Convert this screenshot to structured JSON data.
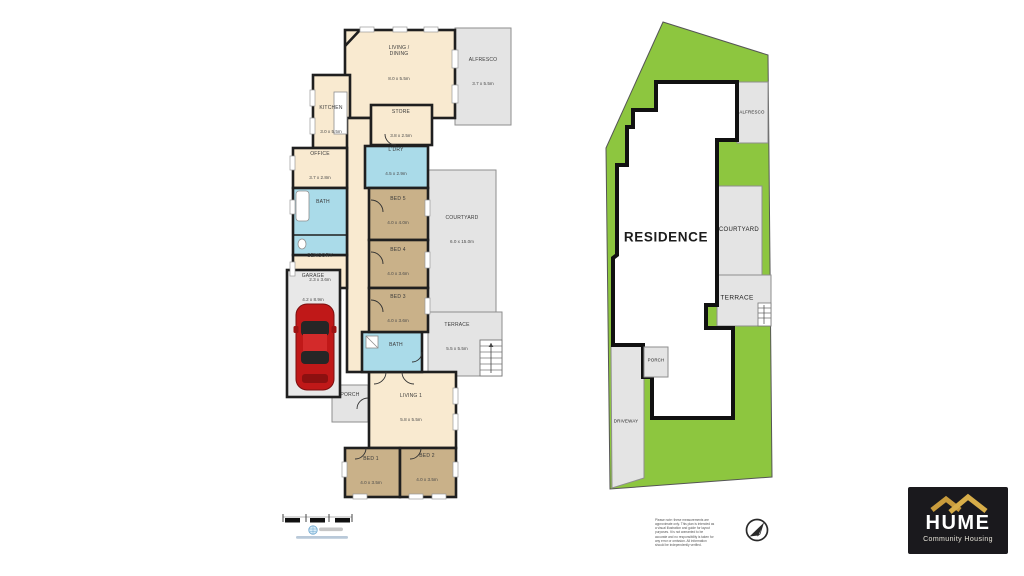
{
  "colors": {
    "room_cream": "#f9ead0",
    "room_tan": "#c9b189",
    "room_blue": "#aadbe9",
    "outdoor_gray": "#e4e4e4",
    "lot_green": "#8dc63f",
    "wall": "#1f1f1f",
    "brand_gold": "#c89b3c",
    "brand_gold_light": "#d7ad49",
    "brand_bg": "#1a191d",
    "car_red": "#c01818"
  },
  "floorplan": {
    "rooms": [
      {
        "label": "LIVING /\nDINING",
        "dims": "8.0 x 5.5m"
      },
      {
        "label": "ALFRESCO",
        "dims": "3.7 x 5.5m"
      },
      {
        "label": "KITCHEN",
        "dims": "3.0 x 5.5m"
      },
      {
        "label": "STORE",
        "dims": "3.8 x 2.5m"
      },
      {
        "label": "OFFICE",
        "dims": "3.7 x 2.8m"
      },
      {
        "label": "L'DRY",
        "dims": "4.5 x 2.9m"
      },
      {
        "label": "BATH"
      },
      {
        "label": "BED 5",
        "dims": "4.0 x 4.0m"
      },
      {
        "label": "SENSORY",
        "dims": "2.3 x 3.6m"
      },
      {
        "label": "BED 4",
        "dims": "4.0 x 3.6m"
      },
      {
        "label": "COURTYARD",
        "dims": "6.0 x 15.0m"
      },
      {
        "label": "GARAGE",
        "dims": "4.2 x 8.9m"
      },
      {
        "label": "BED 3",
        "dims": "4.0 x 3.6m"
      },
      {
        "label": "TERRACE",
        "dims": "5.5 x 5.5m"
      },
      {
        "label": "BATH"
      },
      {
        "label": "PORCH"
      },
      {
        "label": "LIVING 1",
        "dims": "5.8 x 5.5m"
      },
      {
        "label": "BED 1",
        "dims": "4.0 x 3.5m"
      },
      {
        "label": "BED 2",
        "dims": "4.0 x 3.5m"
      }
    ]
  },
  "siteplan": {
    "labels": {
      "residence": "RESIDENCE",
      "alfresco": "ALFRESCO",
      "courtyard": "COURTYARD",
      "terrace": "TERRACE",
      "porch": "PORCH",
      "driveway": "DRIVEWAY"
    }
  },
  "footer": {
    "disclaimer": "Please note: these measurements are approximate only. This plan is intended as a visual illustration and guide for layout purposes. It is not warranted to be accurate and no responsibility is taken for any error or omission. All information should be independently verified."
  },
  "branding": {
    "name": "HUME",
    "tagline": "Community Housing"
  }
}
